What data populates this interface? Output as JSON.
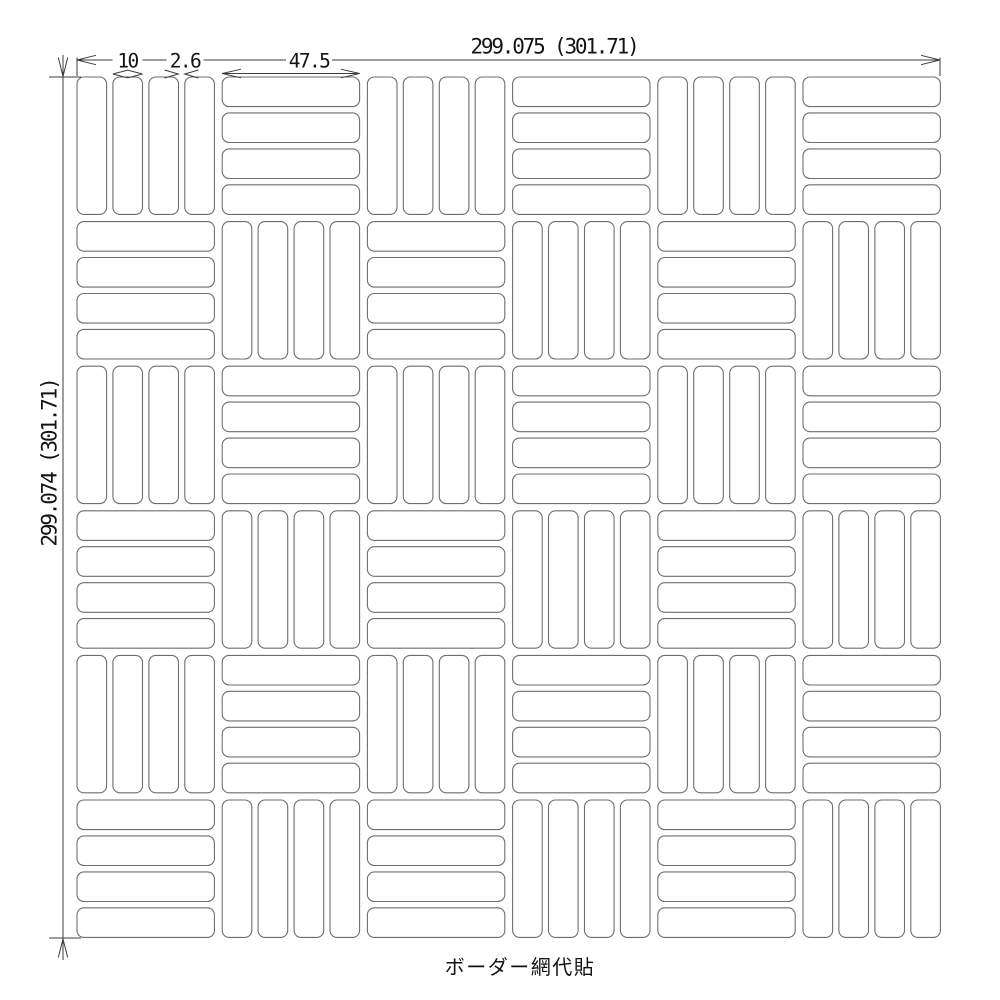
{
  "drawing": {
    "caption": "ボーダー網代貼",
    "dimensions": {
      "overall_width": "299.075 (301.71)",
      "overall_height": "299.074 (301.71)",
      "tile_width": "10",
      "joint_width": "2.6",
      "tile_length": "47.5"
    },
    "pattern": {
      "rows": 6,
      "cols": 6,
      "bars_per_block": 4,
      "first_block_orientation": "vertical",
      "layout": "checkerboard-basketweave"
    },
    "colors": {
      "background": "#ffffff",
      "tile_line": "#6e6e6e",
      "dimension_line": "#3c3c3c",
      "text": "#141414"
    }
  }
}
